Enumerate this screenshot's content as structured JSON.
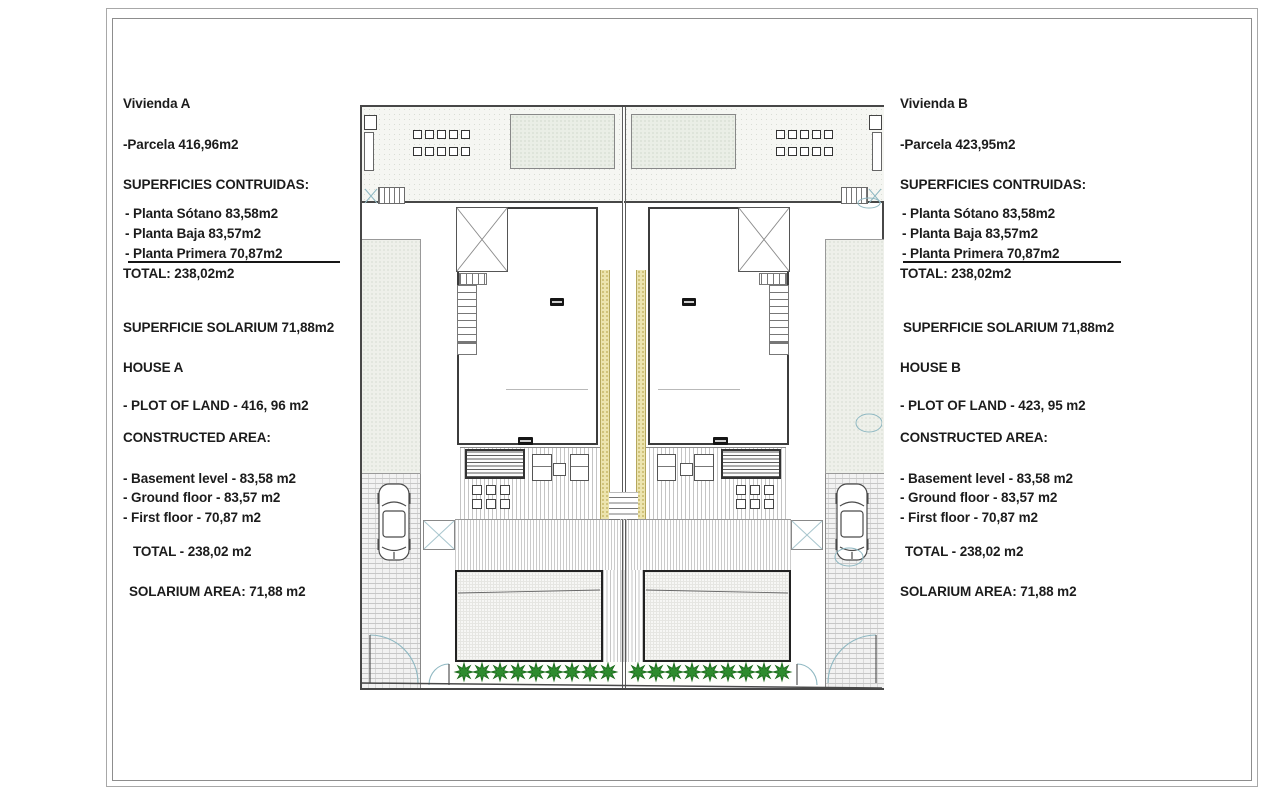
{
  "left_panel": {
    "title": "Vivienda A",
    "parcela": "-Parcela 416,96m2",
    "superficies_heading": "SUPERFICIES CONTRUIDAS:",
    "planta_sotano": "- Planta Sótano 83,58m2",
    "planta_baja": "- Planta Baja 83,57m2",
    "planta_primera": "- Planta Primera 70,87m2",
    "total_es": "TOTAL: 238,02m2",
    "solarium_es": "SUPERFICIE SOLARIUM 71,88m2",
    "house_heading": "HOUSE A",
    "plot_of_land": "- PLOT OF LAND - 416, 96 m2",
    "constructed_heading": "CONSTRUCTED AREA:",
    "basement": "- Basement level - 83,58 m2",
    "ground_floor": "- Ground floor - 83,57 m2",
    "first_floor": "- First floor - 70,87 m2",
    "total_en": "TOTAL - 238,02 m2",
    "solarium_en": "SOLARIUM AREA: 71,88 m2"
  },
  "right_panel": {
    "title": "Vivienda B",
    "parcela": "-Parcela 423,95m2",
    "superficies_heading": "SUPERFICIES CONTRUIDAS:",
    "planta_sotano": "- Planta Sótano 83,58m2",
    "planta_baja": "- Planta Baja 83,57m2",
    "planta_primera": "- Planta Primera 70,87m2",
    "total_es": "TOTAL: 238,02m2",
    "solarium_es": "SUPERFICIE SOLARIUM 71,88m2",
    "house_heading": "HOUSE B",
    "plot_of_land": "- PLOT OF LAND - 423, 95 m2",
    "constructed_heading": "CONSTRUCTED AREA:",
    "basement": "- Basement level - 83,58 m2",
    "ground_floor": "- Ground floor - 83,57 m2",
    "first_floor": "- First floor - 70,87 m2",
    "total_en": "TOTAL - 238,02 m2",
    "solarium_en": "SOLARIUM AREA: 71,88 m2"
  },
  "colors": {
    "plant_green": "#2e8b2e",
    "hatch_yellow": "#ece4ae",
    "arc_blue": "#8fb8c2",
    "ink": "#1c1c1c",
    "wall": "#474747"
  }
}
